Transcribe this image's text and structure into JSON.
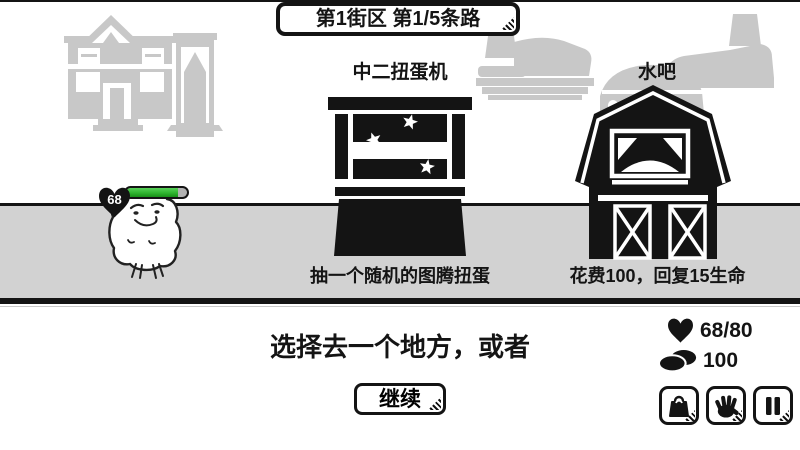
{
  "banner": {
    "text": "第1街区 第1/5条路"
  },
  "locations": [
    {
      "name": "中二扭蛋机",
      "desc": "抽一个随机的图腾扭蛋",
      "icon": "gacha-machine-icon"
    },
    {
      "name": "水吧",
      "desc": "花费100，回复15生命",
      "icon": "barn-icon"
    }
  ],
  "player": {
    "hp_badge": "68",
    "hp_percent": 85
  },
  "bottom": {
    "prompt": "选择去一个地方，或者",
    "continue_label": "继续",
    "stats": {
      "hp": "68/80",
      "coins": "100"
    },
    "buttons": [
      {
        "icon": "bag-icon"
      },
      {
        "icon": "hand-icon"
      },
      {
        "icon": "pause-icon"
      }
    ]
  },
  "colors": {
    "ink": "#141414",
    "ground": "#d2d2d2",
    "silhouette": "#c8c8c8",
    "hp_green": "#2fb52f",
    "hp_empty": "#b2b2b2"
  }
}
